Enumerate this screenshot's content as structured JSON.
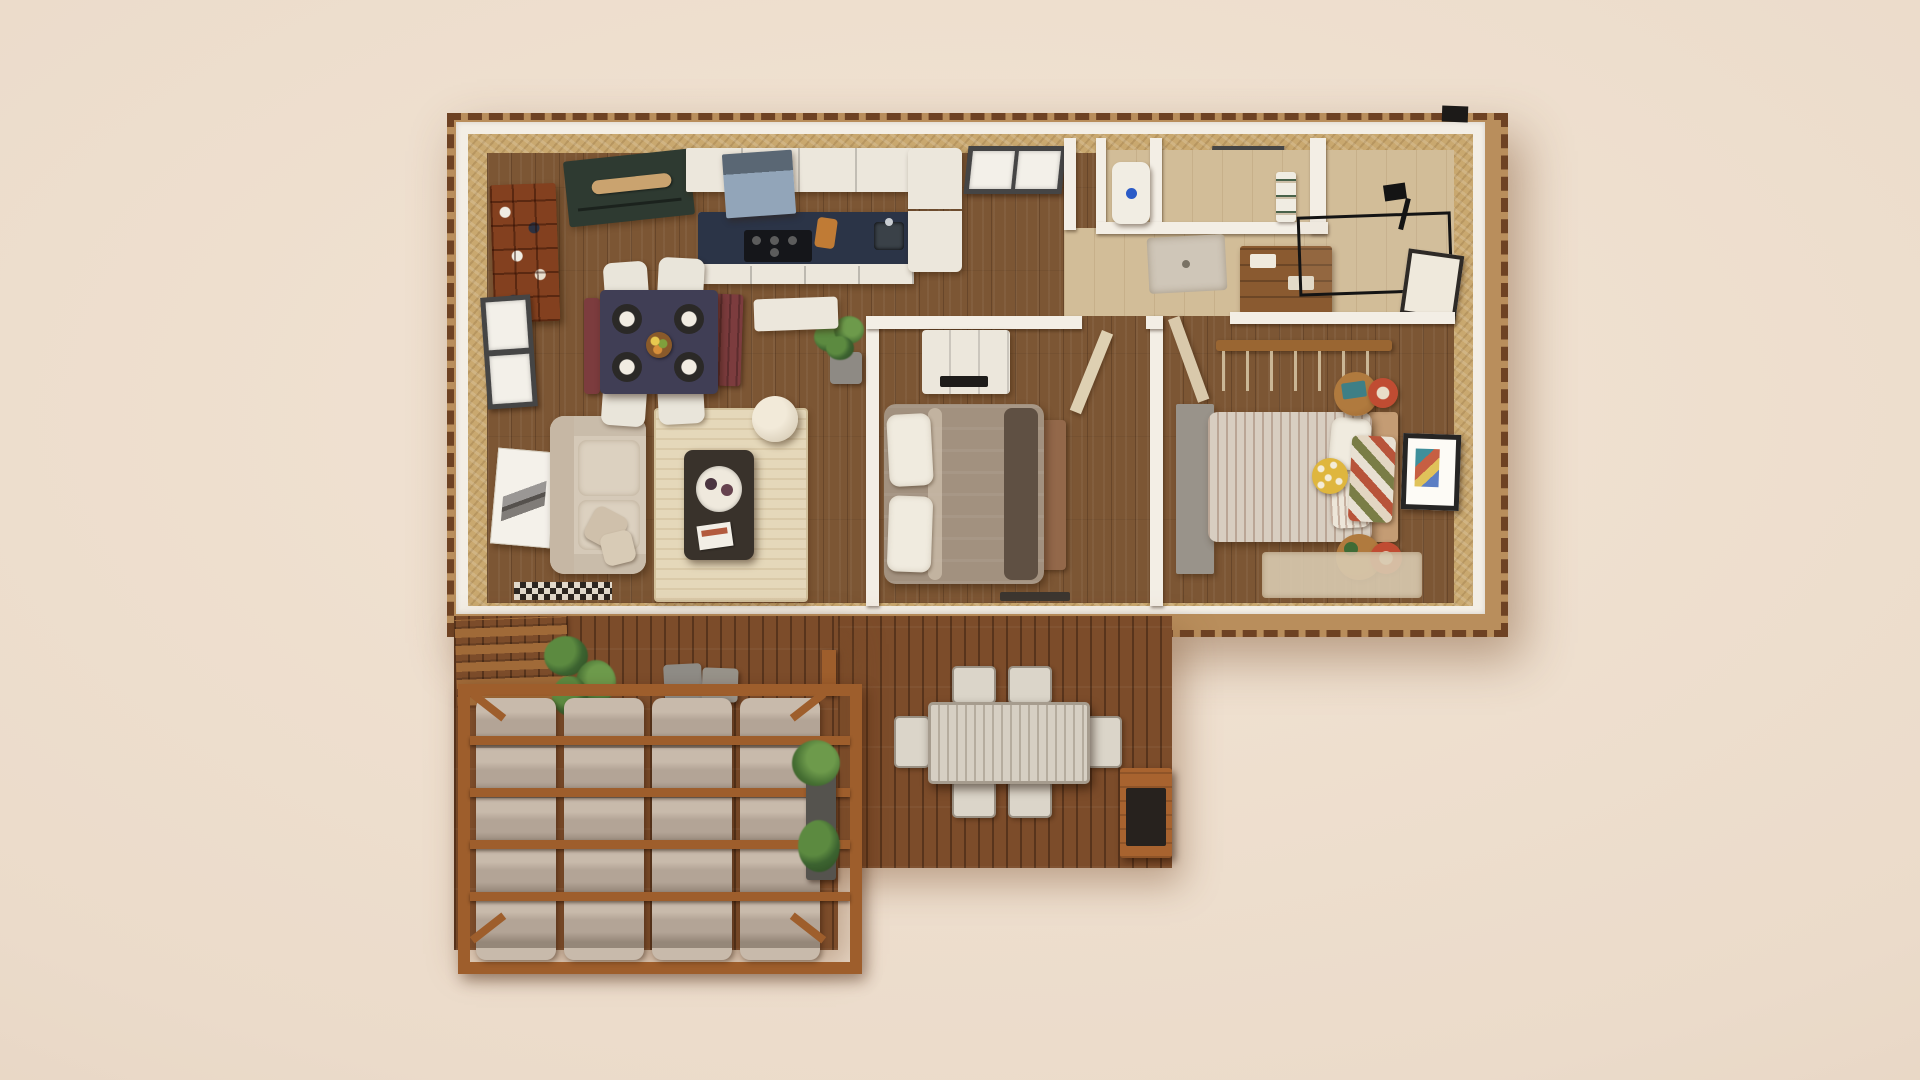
{
  "scene": {
    "type": "3d-floor-plan-render",
    "view": "top-down architectural visualization",
    "description": "Top-down 3D render of a small one-storey house with open living/dining/kitchen, two bedrooms, bathroom block, and a wooden deck with pergola lounge and outdoor dining set on a beige backdrop",
    "rooms": [
      {
        "name": "living-dining-kitchen",
        "furniture": [
          "wine-rack-shelf",
          "left-wall-window",
          "leaning-artwork",
          "beige-sofa",
          "cream-area-rug",
          "dark-coffee-table-with-tray",
          "round-pouf",
          "potted-plant",
          "navy-dining-table",
          "dining-plate-settings-4",
          "fruit-bowl",
          "red-benches-2",
          "white-dining-chairs-4",
          "green-media-cabinet",
          "upper-kitchen-cabinets",
          "range-hood",
          "kitchen-island-with-cooktop-and-sink",
          "refrigerator",
          "kitchen-window",
          "checkered-doormat",
          "white-console-table"
        ]
      },
      {
        "name": "bath-utility-block",
        "furniture": [
          "boiler-unit-with-blue-dial",
          "wc-window",
          "towel-stack",
          "wooden-vanity",
          "shower-tray",
          "black-glass-shower-enclosure",
          "black-shower-fixture",
          "wall-mirror",
          "roof-vent"
        ]
      },
      {
        "name": "bedroom-1",
        "furniture": [
          "white-dresser-tv-unit",
          "double-bed-taupe-duvet",
          "white-pillow-stacks-2",
          "wooden-foot-bench",
          "open-door-leaf",
          "dark-floor-mat"
        ]
      },
      {
        "name": "bedroom-2",
        "furniture": [
          "hanging-clothes-rail",
          "gray-sideboard",
          "striped-double-bed",
          "white-and-striped-pillows",
          "yellow-polka-dot-pillow",
          "patchwork-quilt",
          "round-wooden-side-tables-2",
          "red-ring-stools-2",
          "framed-wall-art",
          "bedside-rug",
          "open-door-leaf"
        ]
      },
      {
        "name": "deck-and-pergola",
        "furniture": [
          "slatted-privacy-fence",
          "pergola-frame",
          "woven-canvas-shade-strips-4",
          "gray-cube-stools-2",
          "planter-shrubs",
          "tall-planter-plant",
          "slatted-outdoor-dining-table",
          "outdoor-chairs-6",
          "grill-bar-cart"
        ]
      }
    ],
    "counts": {
      "bedrooms": 2,
      "beds": 2,
      "indoor-dining-chairs": 4,
      "outdoor-chairs": 6,
      "canvas-shade-strips": 4,
      "windows-top-wall": 2
    }
  },
  "palette": {
    "bg": "#ebdbca",
    "bg_hi": "#f2e4d4",
    "bg_lo": "#e0cbb8",
    "rim": "#b98e5c",
    "rim_dash": "#6e4223",
    "wall_white": "#f3eee5",
    "wall_tan": "#c9a86f",
    "tile": "#d2bd98",
    "floor_wood": "#7c5634",
    "deck_wood": "#7c4c2a",
    "pergola_wood": "#9e5e2c",
    "canvas": "#b3a496",
    "canvas_hi": "#c8baab",
    "canvas_lo": "#958779",
    "white_furn": "#ece7dc",
    "pillow": "#f0ebdf",
    "green_cabinet": "#2e3a31",
    "navy_counter": "#2b3447",
    "hood_blue": "#92a5b9",
    "table_navy": "#403e55",
    "bench_red": "#7c3c3e",
    "sofa": "#d5c9b8",
    "rug": "#e5d8ba",
    "duvet_taupe": "#a2917f",
    "stripe_base": "#d8cec1",
    "accent_red": "#c04c32",
    "accent_yellow": "#dfb63e",
    "wood_mid": "#9a6632",
    "gray_unit": "#99938a",
    "glass_black": "#141414",
    "boiler_blue": "#2b5bc7",
    "outdoor_chair": "#dbd5c9",
    "outdoor_table": "#d6cfc3"
  }
}
